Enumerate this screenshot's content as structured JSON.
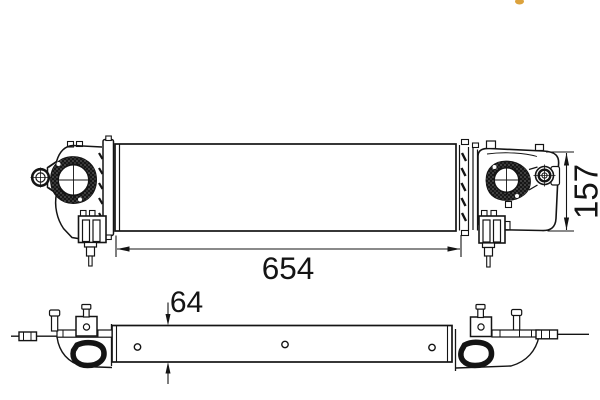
{
  "colors": {
    "background": "#ffffff",
    "ink": "#141414",
    "watermark": "#dca23c"
  },
  "front_view": {
    "width_dimension": "654",
    "height_dimension": "157"
  },
  "top_view": {
    "depth_dimension": "64"
  }
}
